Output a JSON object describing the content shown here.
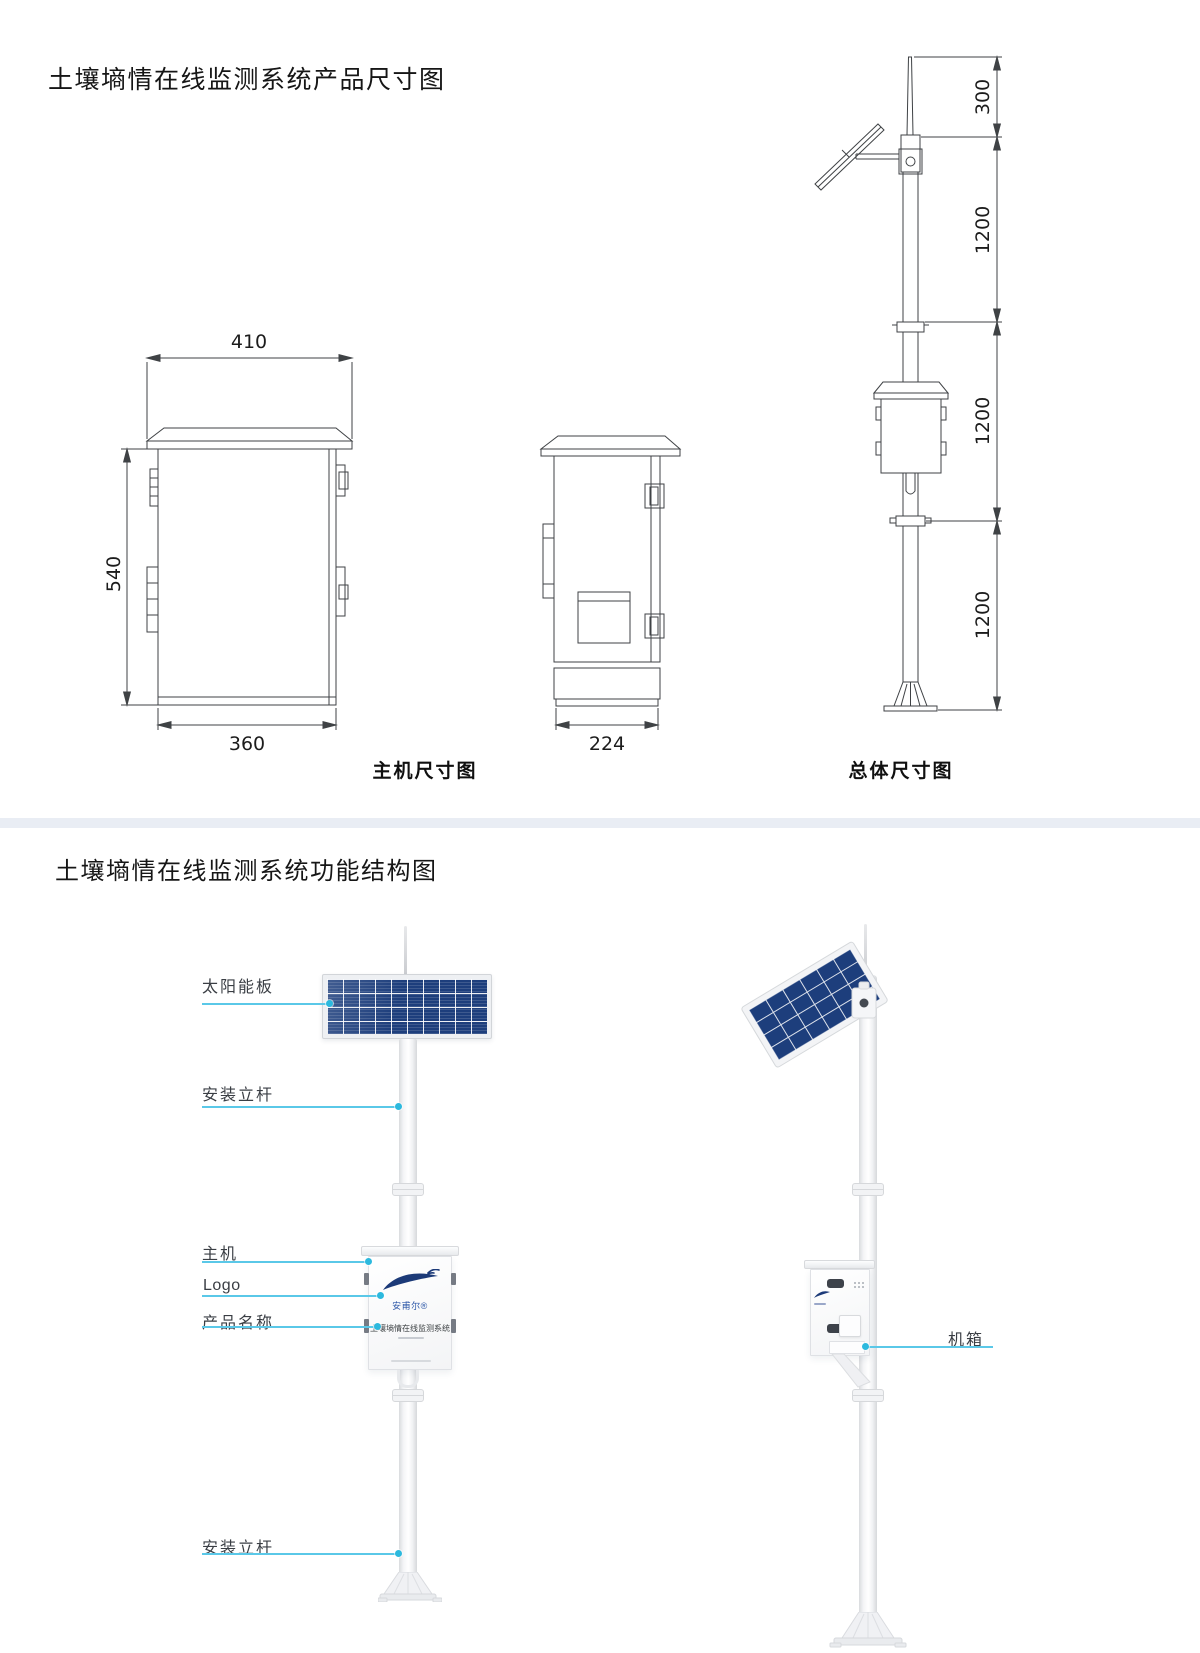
{
  "dim_section": {
    "title": "土壤墒情在线监测系统产品尺寸图",
    "caption_host": "主机尺寸图",
    "caption_overall": "总体尺寸图",
    "front_view": {
      "top_width": "410",
      "height": "540",
      "bottom_width": "360"
    },
    "side_view": {
      "depth": "224"
    },
    "overall_view": {
      "antenna": "300",
      "upper_pole": "1200",
      "middle_pole": "1200",
      "lower_pole": "1200"
    }
  },
  "func_section": {
    "title": "土壤墒情在线监测系统功能结构图",
    "callouts": {
      "solar_panel": "太阳能板",
      "mount_pole_upper": "安装立杆",
      "host": "主机",
      "logo": "Logo",
      "product_name": "产品名称",
      "mount_pole_lower": "安装立杆",
      "cabinet": "机箱"
    },
    "device": {
      "brand": "安甫尔®",
      "name": "土壤墒情在线监测系统"
    },
    "colors": {
      "callout_line": "#5ac8e8",
      "callout_dot": "#2cb9de",
      "panel_blue": "#1d3e7c",
      "logo_blue": "#1c3a78",
      "divider": "#e9edf4"
    }
  }
}
